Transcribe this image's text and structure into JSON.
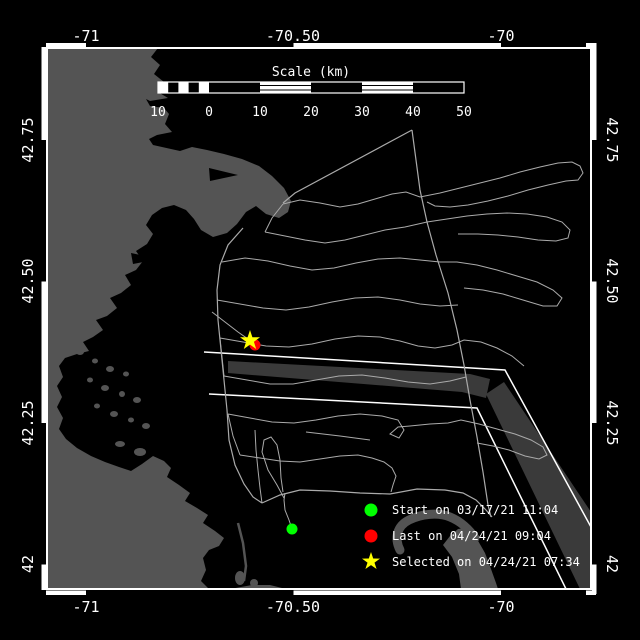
{
  "window": {
    "background": "#000000"
  },
  "map": {
    "lon_ticks": [
      "-71",
      "-70.50",
      "-70"
    ],
    "lat_ticks": [
      "42.75",
      "42.50",
      "42.25",
      "42"
    ]
  },
  "scale_bar": {
    "title": "Scale (km)",
    "labels": [
      "10",
      "0",
      "10",
      "20",
      "30",
      "40",
      "50"
    ]
  },
  "legend": {
    "items": [
      {
        "marker": "circle",
        "color": "#00ff00",
        "label": "Start on 03/17/21 11:04"
      },
      {
        "marker": "circle",
        "color": "#ff0000",
        "label": "Last on 04/24/21 09:04"
      },
      {
        "marker": "star",
        "color": "#ffff00",
        "label": "Selected on 04/24/21 07:34"
      }
    ]
  },
  "colors": {
    "land": "#545454",
    "ocean": "#000000",
    "track": "#aaaaaa",
    "separation_zone": "#3a3a3a",
    "frame": "#ffffff",
    "text": "#ffffff"
  }
}
